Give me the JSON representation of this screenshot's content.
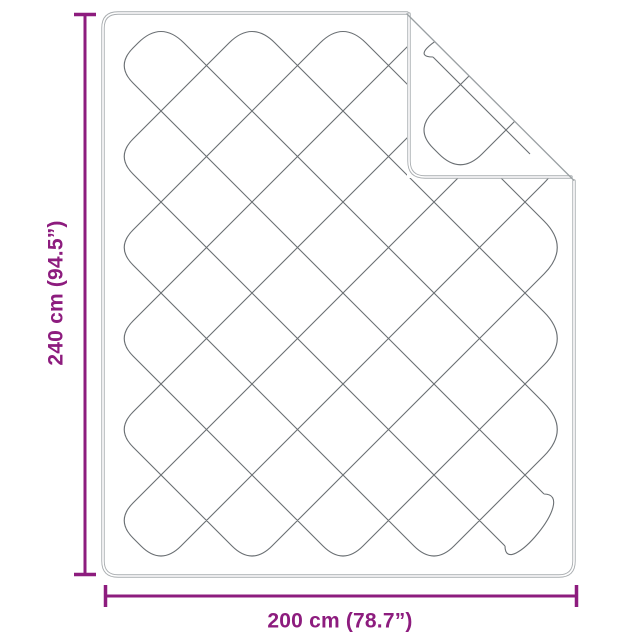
{
  "figure": {
    "alt": "Line drawing of a quilted blanket with diamond stitching, top-right corner folded over, annotated with dimensions"
  },
  "dimensions": {
    "height_label": "240 cm (94.5”)",
    "width_label": "200 cm (78.7”)"
  },
  "style": {
    "accent_color": "#8d1c7e",
    "outline_color": "#a9adb0",
    "pattern_color": "#6a6f73",
    "crease_color": "#9aa0a3"
  }
}
